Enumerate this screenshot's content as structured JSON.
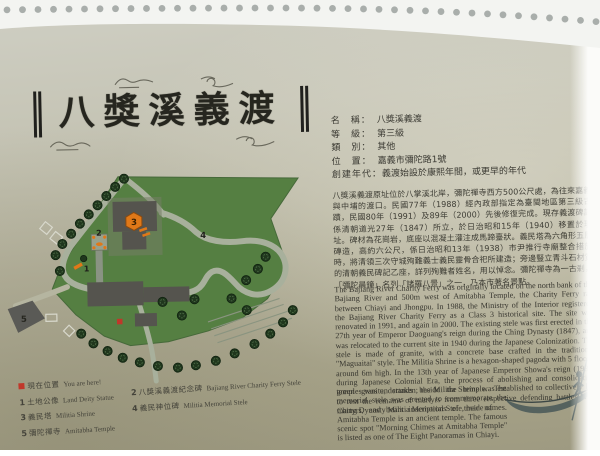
{
  "plaque": {
    "title": {
      "text": "八獎溪義渡"
    },
    "info": {
      "rows": [
        {
          "label": "名　稱：",
          "value": "八獎溪義渡"
        },
        {
          "label": "等　級：",
          "value": "第三級"
        },
        {
          "label": "類　別：",
          "value": "其他"
        },
        {
          "label": "位　置：",
          "value": "嘉義市彌陀路1號"
        },
        {
          "label": "創建年代：",
          "value": "義渡始設於康熙年間，或更早的年代"
        }
      ]
    },
    "description_zh": "八獎溪義渡原址位於八掌溪北岸，彌陀禪寺西方500公尺處，為往來嘉義與中埔的渡口。民國77年（1988）經內政部指定為臺閩地區第三級古蹟，民國80年（1991）及89年（2000）先後修復完成。現存義渡碑記係清朝道光27年（1847）所立，於日治昭和15年（1940）移置於現址。碑材為花崗岩，底座以混凝土灌注成馬蹄臺狀。義民塔為六角形五層磚造，高約六公尺，係日治昭和13年（1938）市尹推行寺廟整合措施時，將清領三次守城殉難義士義民靈骨合祀所建造；旁邊豎立青斗石材質的清朝義民碑記乙座，詳列殉難者姓名，用以悼念。彌陀禪寺為一古剎，「彌陀晨鐘」名列「諸羅八景」之一，乃本市著名景點。",
    "description_en_1": "The Bajiang River Charity Ferry was originally located on the north bank of the Bajiang River and 500m west of Amitabha Temple, the Charity Ferry ran between Chiayi and Jhongpu. In 1988, the Ministry of the Interior registered the Bajiang River Charity Ferry as a Class 3 historical site. The site was renovated in 1991, and again in 2000. The existing stele was first erected in the 27th year of Emperor Daoguang's reign during the Ching Dynasty (1847), and was relocated to the current site in 1940 during the Japanese Colonization. The stele is made of granite, with a concrete base crafted in the traditional \"Maguaitai\" style. The Militia Shrine is a hexagon-shaped pagoda with 5 floors, around 6m high. In the 13th year of Japanese Emperor Showa's reign (1938) during Japanese Colonial Era, the process of abolishing and consolidating temples was undertaken; the Militia Shrine was established to collectively lay to rest the remains of martyrs from three respective defending battles. The Ching Dynasty Militia Memorial Stele, made of",
    "description_en_2": "green granite, stands beside the temple. The memorial stele was erected to commemorate the martyrs, and bears inscriptions of their names. Amitabha Temple is an ancient temple. The famous scenic spot \"Morning Chimes at Amitabha Temple\" is listed as one of The Eight Panoramas in Chiayi.",
    "legend": {
      "you_are_here": {
        "zh": "現在位置",
        "en": "You are here!"
      },
      "items": [
        {
          "num": "1",
          "zh": "土地公像",
          "en": "Land Deity Statue"
        },
        {
          "num": "2",
          "zh": "八獎溪義渡紀念碑",
          "en": "Bajiang River Charity Ferry Stele"
        },
        {
          "num": "3",
          "zh": "義民塔",
          "en": "Militia Shrine"
        },
        {
          "num": "4",
          "zh": "義民神位碑",
          "en": "Militia Memorial Stele"
        },
        {
          "num": "5",
          "zh": "彌陀禪寺",
          "en": "Amitabha Temple"
        }
      ]
    },
    "colors": {
      "plaque_top": "#cfcfc4",
      "plaque_bottom": "#9e9a81",
      "map_green": "#557f42",
      "road_gray": "#a8b09c",
      "building_gray": "#55544e",
      "marker_orange": "#e07818",
      "you_are_here_red": "#c0372a",
      "boat_teal": "#55625e"
    }
  }
}
